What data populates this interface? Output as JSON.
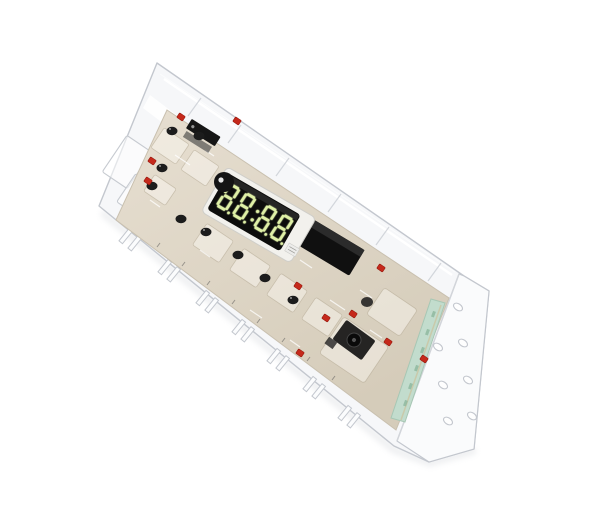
{
  "meta": {
    "subject": "Electronic oven range control board (clock timer) inside a clear protective plastic cover, tilted on a seamless white background",
    "object_tilt_degrees": 33
  },
  "display": {
    "value": "88:88",
    "decimal_points": true,
    "digit_count": 4,
    "style": "seven-segment"
  },
  "counts": {
    "flange_holes": 7,
    "bottom_clips": 7,
    "red_components": 13,
    "capacitors": 10
  },
  "colors": {
    "background": "#ffffff",
    "case_line": "#c3c7ce",
    "case_fill": "#f6f7f9",
    "fold": "#d2d5da",
    "highlight": "#ffffff",
    "board_stroke": "#c9c0af",
    "pcb_light": "#e7dfd1",
    "pcb_dark": "#d5ccba",
    "display_window": "#0d0d0c",
    "display_bezel": "#f2f1ed",
    "segment_green": "#dff0a6",
    "component_red": "#c5291b",
    "component_red_dark": "#8e1208",
    "component_black": "#161616",
    "capacitor_black": "#1c1c1c",
    "edge_connector": "#c2dccd",
    "edge_connector_stroke": "#a7c7b4",
    "gold_fingers": "#cdbd92"
  }
}
